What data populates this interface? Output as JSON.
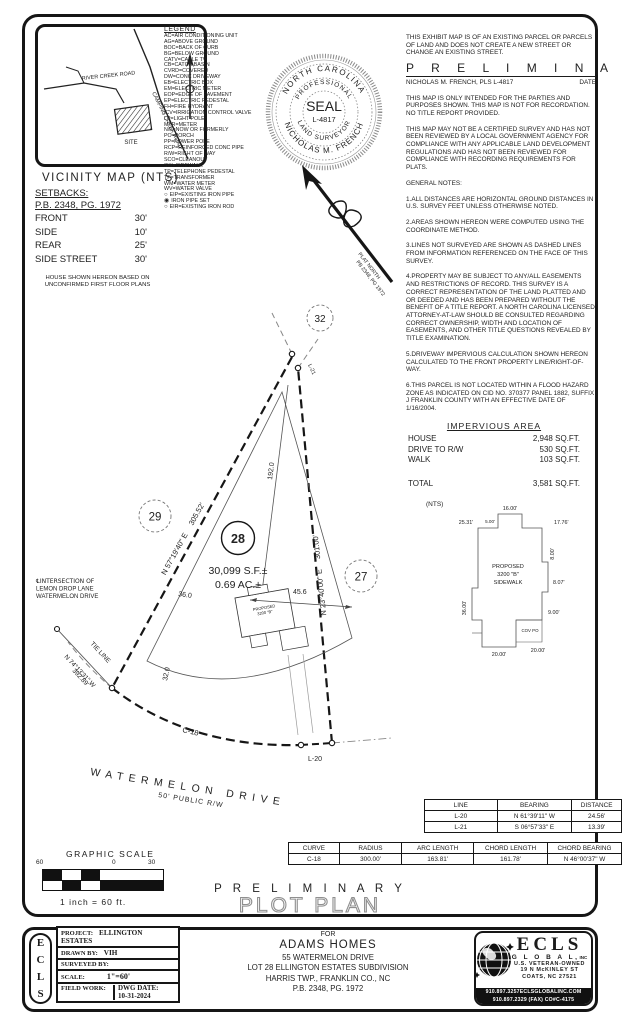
{
  "colors": {
    "ink": "#161616",
    "light_line": "#777777",
    "outline_title": "#8f8f8f"
  },
  "vicinity": {
    "title": "VICINITY MAP (NTS)",
    "road1": "RIVER CREEK ROAD",
    "road2": "CAMPING CREEK ROAD",
    "site_label": "SITE"
  },
  "legend": {
    "title": "LEGEND",
    "items": [
      "AC=AIR CONDITIONING UNIT",
      "AG=ABOVE GROUND",
      "BOC=BACK OF CURB",
      "BG=BELOW GROUND",
      "CATV=CABLE TV",
      "CB=CATCH BASIN",
      "CVRD=COVERED",
      "DW=CONC DRIVEWAY",
      "EB=ELECTRIC BOX",
      "EM=ELECTRIC METER",
      "EOP=EDGE OF PAVEMENT",
      "EP=ELECTRIC PEDESTAL",
      "FH=FIRE HYDRANT",
      "ICV=IRRIGATION CONTROL VALVE",
      "LP=LIGHT POLE",
      "MTR=METER",
      "N/F=NOW OR FORMERLY",
      "PO=PORCH",
      "PP=POWER POLE",
      "RCP=REINFORCED CONC PIPE",
      "R/W=RIGHT OF WAY",
      "SCO=CLEANOUT",
      "SW=SIDEWALK",
      "TP=TELEPHONE PEDESTAL",
      "TF=TRANSFORMER",
      "WM=WATER METER",
      "WV=WATER VALVE"
    ],
    "symbols": [
      {
        "glyph": "○",
        "label": "EIP=EXISTING IRON PIPE"
      },
      {
        "glyph": "◉",
        "label": "IRON PIPE SET"
      },
      {
        "glyph": "○",
        "label": "EIR=EXISTING IRON ROD"
      }
    ]
  },
  "seal": {
    "outer_top": "NORTH CAROLINA",
    "outer_bottom": "NICHOLAS M. FRENCH",
    "inner_top": "PROFESSIONAL",
    "inner_bottom": "LAND SURVEYOR",
    "center1": "SEAL",
    "center2": "L-4817"
  },
  "north_arrow": {
    "line1": "PLAT NORTH",
    "line2": "PB 2348, PG 1972"
  },
  "statements": {
    "exhibit": "THIS EXHIBIT MAP IS OF AN EXISTING PARCEL OR PARCELS OF LAND AND DOES NOT CREATE A NEW STREET OR CHANGE AN EXISTING STREET.",
    "preliminary": "P R E L I M I N A R Y",
    "signature_line": "NICHOLAS M. FRENCH, PLS L-4817",
    "date_label": "DATE",
    "intended": "THIS MAP IS ONLY INTENDED FOR THE PARTIES AND PURPOSES SHOWN. THIS MAP IS NOT FOR RECORDATION. NO TITLE REPORT PROVIDED.",
    "not_certified": "THIS MAP MAY NOT BE A CERTIFIED SURVEY AND HAS NOT BEEN REVIEWED BY A LOCAL GOVERNMENT AGENCY FOR COMPLIANCE WITH ANY APPLICABLE LAND DEVELOPMENT REGULATIONS AND HAS NOT BEEN REVIEWED FOR COMPLIANCE WITH RECORDING REQUIREMENTS FOR PLATS."
  },
  "general_notes": {
    "title": "GENERAL NOTES:",
    "items": [
      "1.ALL DISTANCES ARE HORIZONTAL GROUND DISTANCES IN U.S. SURVEY FEET UNLESS OTHERWISE NOTED.",
      "2.AREAS SHOWN HEREON WERE COMPUTED USING THE COORDINATE METHOD.",
      "3.LINES NOT SURVEYED ARE SHOWN AS DASHED LINES FROM INFORMATION REFERENCED ON THE FACE OF THIS SURVEY.",
      "4.PROPERTY MAY BE SUBJECT TO ANY/ALL EASEMENTS AND RESTRICTIONS OF RECORD. THIS SURVEY IS A CORRECT REPRESENTATION OF THE LAND PLATTED AND OR DEEDED AND HAS BEEN PREPARED WITHOUT THE BENEFIT OF A TITLE REPORT. A NORTH CAROLINA LICENSED ATTORNEY-AT-LAW SHOULD BE CONSULTED REGARDING CORRECT OWNERSHIP, WIDTH AND LOCATION OF EASEMENTS, AND OTHER TITLE QUESTIONS REVEALED BY TITLE EXAMINATION.",
      "5.DRIVEWAY IMPERVIOUS CALCULATION SHOWN HEREON CALCULATED TO THE FRONT PROPERTY LINE/RIGHT-OF-WAY.",
      "6.THIS PARCEL IS NOT LOCATED WITHIN A FLOOD HAZARD ZONE AS INDICATED ON CID NO. 370377 PANEL 1882, SUFFIX J FRANKLIN COUNTY WITH AN EFFECTIVE DATE OF 1/16/2004."
    ]
  },
  "impervious": {
    "title": "IMPERVIOUS AREA",
    "rows": [
      {
        "label": "HOUSE",
        "value": "2,948 SQ.FT."
      },
      {
        "label": "DRIVE TO R/W",
        "value": "530 SQ.FT."
      },
      {
        "label": "WALK",
        "value": "103 SQ.FT."
      }
    ],
    "total_label": "TOTAL",
    "total_value": "3,581 SQ.FT."
  },
  "setbacks": {
    "title": "SETBACKS:",
    "ref": "P.B. 2348, PG. 1972",
    "rows": [
      {
        "label": "FRONT",
        "value": "30'"
      },
      {
        "label": "SIDE",
        "value": "10'"
      },
      {
        "label": "REAR",
        "value": "25'"
      },
      {
        "label": "SIDE STREET",
        "value": "30'"
      }
    ],
    "note": "HOUSE SHOWN HEREON BASED ON UNCONFIRMED FIRST FLOOR PLANS"
  },
  "plot": {
    "lot28": "28",
    "lot29": "29",
    "lot27": "27",
    "lot32": "32",
    "area_sf": "30,099 S.F.±",
    "area_ac": "0.69 AC.±",
    "bearing_left": "N 57°19'40\" E",
    "dist_left": "305.52'",
    "bearing_right": "N 23°40'00\" E",
    "dist_right": "301.00'",
    "interior_dim": "192.0",
    "dim_a": "36.0",
    "dim_b": "45.6",
    "dim_c": "32.0",
    "curve": "C-18",
    "l20": "L-20",
    "l21": "L-21",
    "tie": "TIE LINE",
    "tie_bearing": "N 74°13'31\" W",
    "tie_dist": "392.89'",
    "intersection1": "℄INTERSECTION OF",
    "intersection2": "LEMON DROP LANE",
    "intersection3": "WATERMELON DRIVE",
    "street": "WATERMELON DRIVE",
    "street_rw": "50' PUBLIC R/W",
    "house_tag1": "PROPOSED",
    "house_tag2": "3200 \"B\""
  },
  "house_inset": {
    "nts": "(NTS)",
    "label1": "PROPOSED",
    "label2": "3200 \"B\"",
    "label3": "SIDEWALK",
    "d_top": "16.00'",
    "d_top2": "5.00'",
    "d_left_top": "25.31'",
    "d_right_top": "17.76'",
    "d_right": "8.00'",
    "d_left": "36.00'",
    "d_right2": "8.07'",
    "d_right3": "9.00'",
    "d_bottom": "20.00'",
    "d_bottom2": "20.00'",
    "cov": "COV PO"
  },
  "line_table": {
    "headers": [
      "LINE",
      "BEARING",
      "DISTANCE"
    ],
    "rows": [
      [
        "L-20",
        "N 61°39'11\" W",
        "24.56'"
      ],
      [
        "L-21",
        "S 06°57'33\" E",
        "13.39'"
      ]
    ]
  },
  "curve_table": {
    "headers": [
      "CURVE",
      "RADIUS",
      "ARC LENGTH",
      "CHORD LENGTH",
      "CHORD BEARING"
    ],
    "rows": [
      [
        "C-18",
        "300.00'",
        "163.81'",
        "161.78'",
        "N 46°00'37\" W"
      ]
    ]
  },
  "scale_bar": {
    "title": "GRAPHIC SCALE",
    "tick_left": "60",
    "tick_mid": "0",
    "tick_right": "30",
    "caption": "1 inch = 60 ft."
  },
  "titles": {
    "preliminary": "P R E L I M I N A R Y",
    "plot_plan": "PLOT PLAN"
  },
  "title_block": {
    "project_label": "PROJECT:",
    "project": "ELLINGTON ESTATES",
    "drawn_label": "DRAWN BY:",
    "drawn": "VIH",
    "surveyed_label": "SURVEYED BY:",
    "scale_label": "SCALE:",
    "scale": "1\"=60'",
    "field_label": "FIELD WORK:",
    "dwg_label": "DWG DATE:",
    "dwg_date": "10-31-2024",
    "e": "E",
    "c": "C",
    "l": "L",
    "s": "S",
    "for_label": "FOR",
    "client": "ADAMS HOMES",
    "address": "55 WATERMELON DRIVE",
    "lot_line": "LOT 28  ELLINGTON ESTATES SUBDIVISION",
    "township": "HARRIS TWP., FRANKLIN CO., NC",
    "plat_ref": "P.B. 2348, PG. 1972"
  },
  "ecls": {
    "name": "ECLS",
    "global": "G L O B A L,",
    "inc": "INC",
    "veteran": "U.S. VETERAN-OWNED",
    "street": "19 N McKINLEY ST",
    "city": "COATS, NC  27521",
    "phone1": "910.897.3257ECLSGLOBALINC.COM",
    "phone2": "910.897.2329 (FAX) CO#C-4175"
  }
}
